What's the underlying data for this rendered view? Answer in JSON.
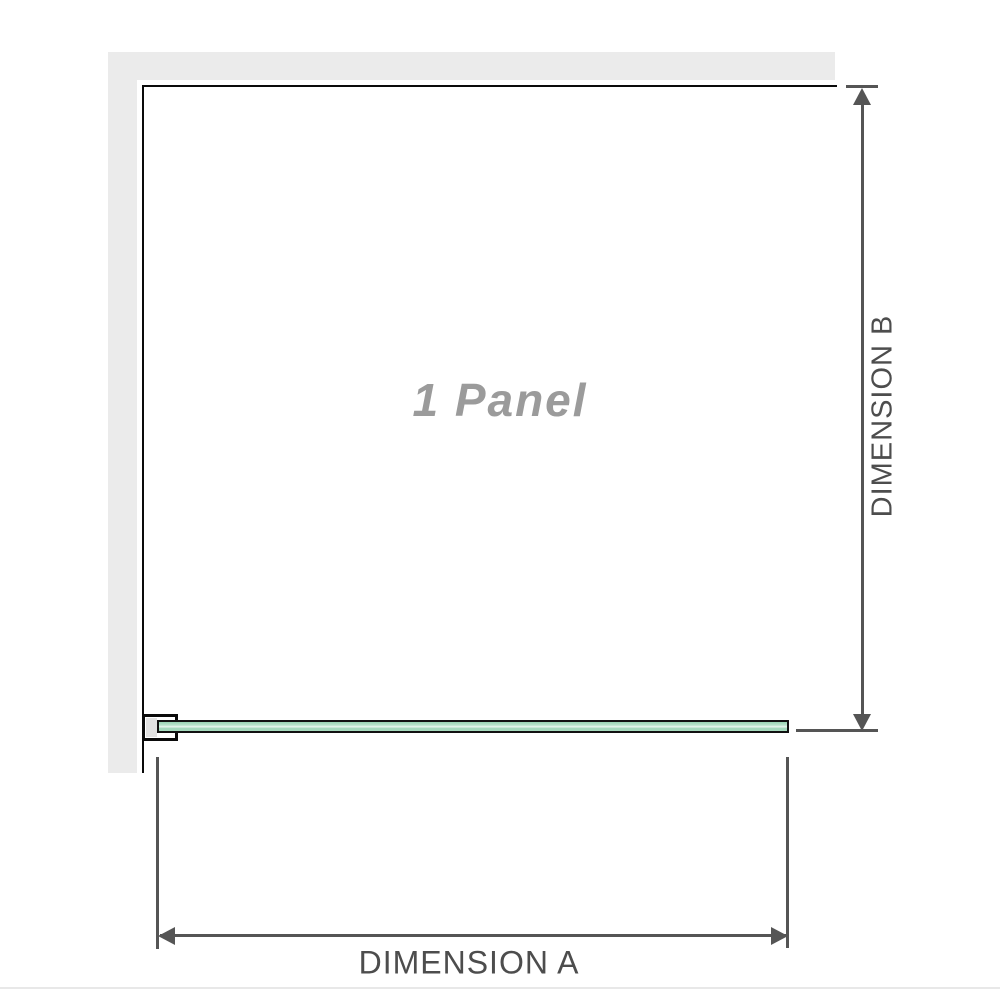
{
  "diagram": {
    "panel_label": "1 Panel",
    "dimension_a_label": "DIMENSION A",
    "dimension_b_label": "DIMENSION B"
  },
  "icons": {
    "arrow_up": "arrow-up-icon",
    "arrow_down": "arrow-down-icon",
    "arrow_left": "arrow-left-icon",
    "arrow_right": "arrow-right-icon"
  },
  "colors": {
    "wall": "#ebebeb",
    "outline": "#0a0a0a",
    "dimension": "#555555",
    "label_text": "#4d4d4d",
    "panel_label_text": "#9b9b9b",
    "glass_border": "#111111",
    "glass_fill": "#a8dcbf",
    "glass_highlight": "#e8f6ee",
    "baseline": "#e8e8e8"
  }
}
